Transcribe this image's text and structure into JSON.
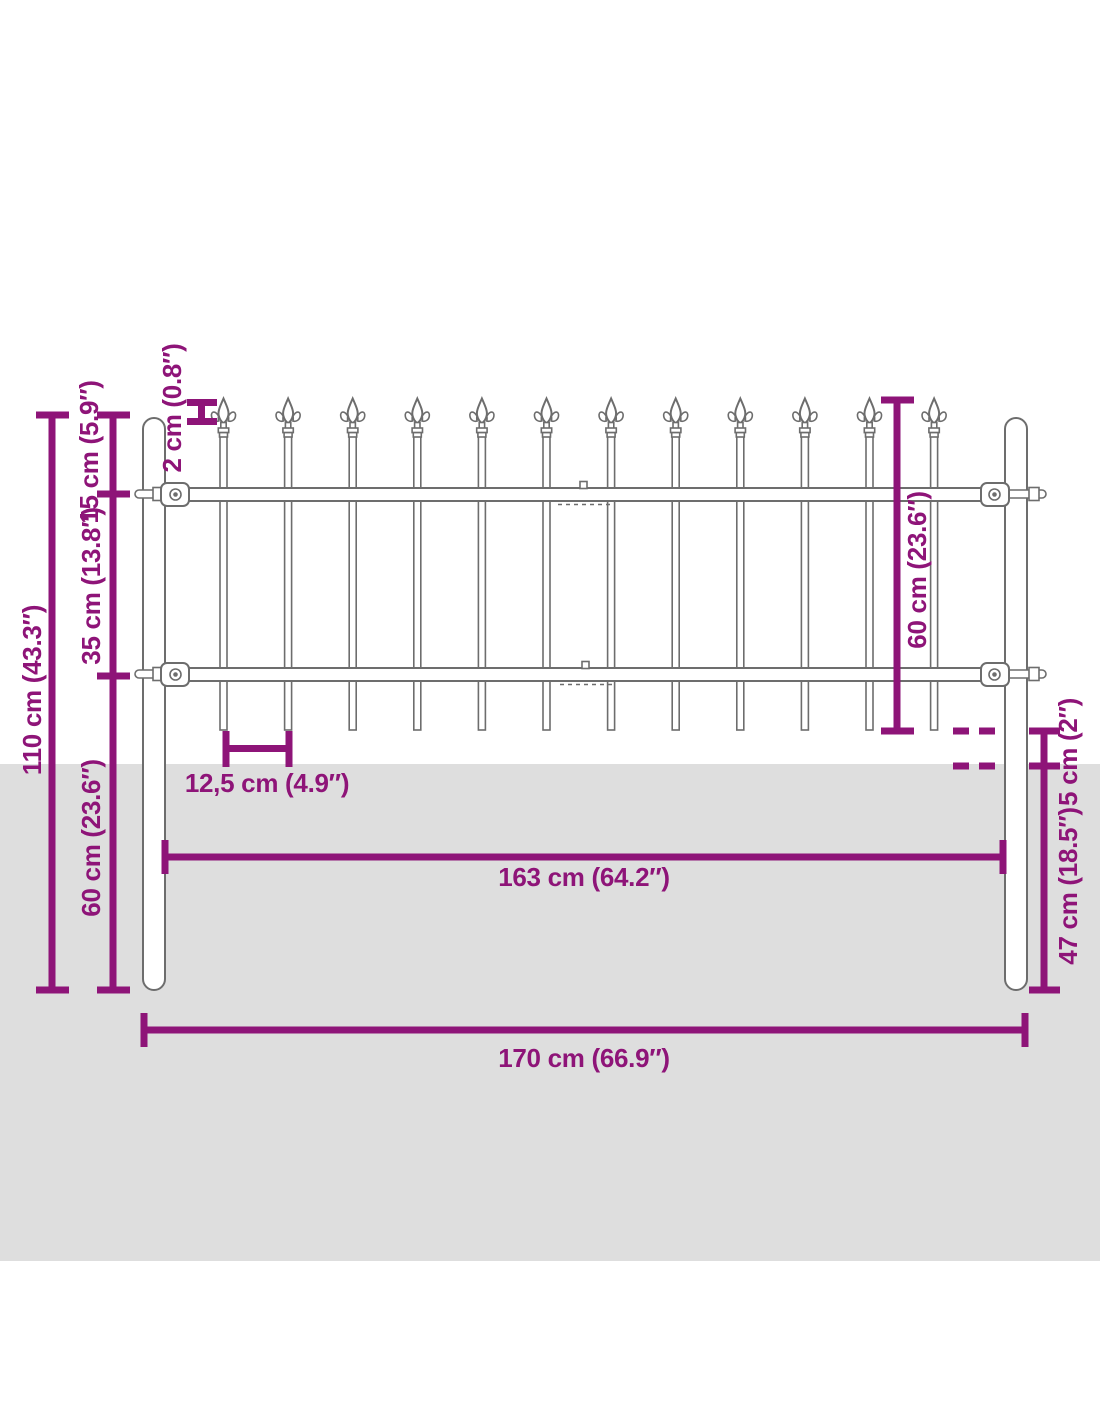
{
  "diagram": {
    "title": "fence-dimension-diagram",
    "product": "steel garden fence with spear top"
  },
  "colors": {
    "dimension": "#8e1478",
    "outline": "#6d6d6d",
    "fill": "#ffffff",
    "ground": "#dedede",
    "background": "#ffffff"
  },
  "fence": {
    "picket_count": 12,
    "post_count": 2,
    "rail_count": 2,
    "finial_style": "spear-fleur-de-lis"
  },
  "labels": {
    "total_height": "110 cm (43.3″)",
    "top_section": "15 cm (5.9″)",
    "rail_spacing": "35 cm (13.8″)",
    "post_below_panel": "60 cm (23.6″)",
    "spear_height": "2 cm (0.8″)",
    "panel_height": "60 cm (23.6″)",
    "picket_spacing": "12,5 cm (4.9″)",
    "inner_width": "163 cm (64.2″)",
    "ground_clearance": "5 cm (2″)",
    "below_ground_depth": "47 cm (18.5″)",
    "total_width": "170 cm (66.9″)"
  }
}
